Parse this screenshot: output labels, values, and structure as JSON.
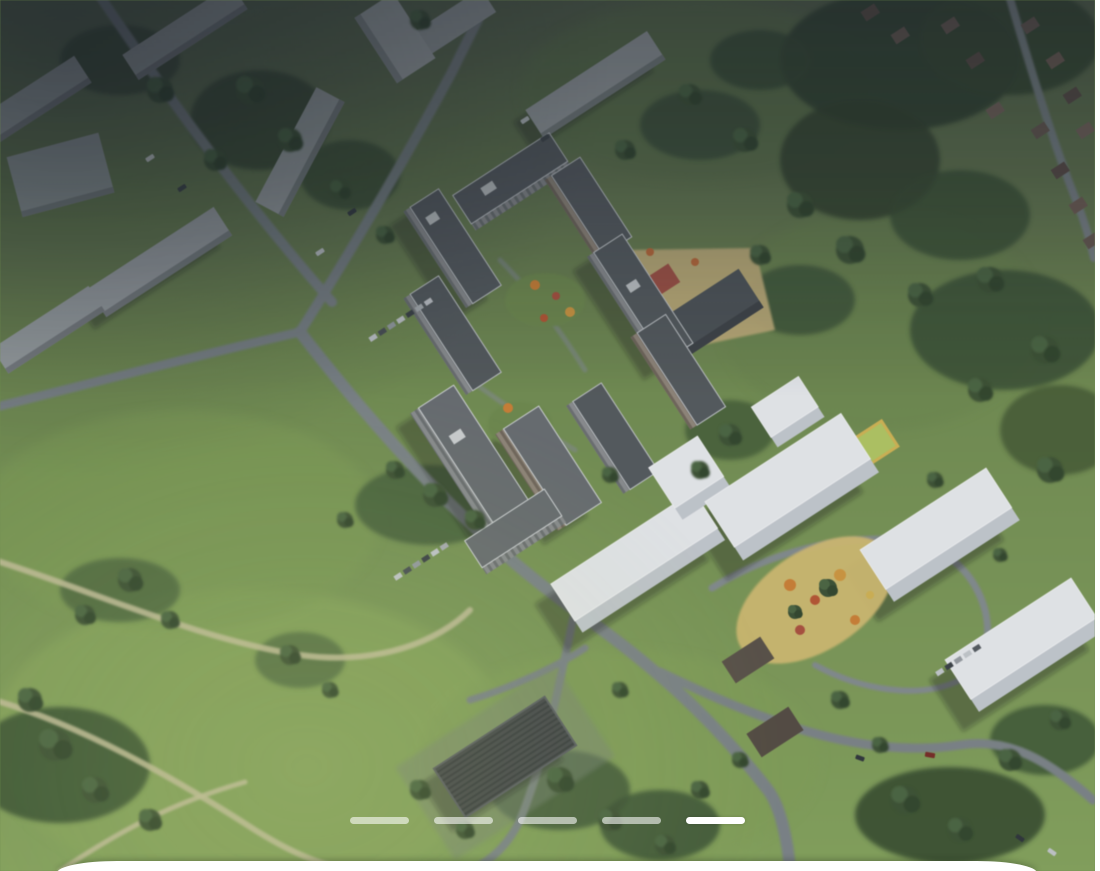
{
  "app": {
    "view": "real-estate-listing-photo-viewer"
  },
  "carousel": {
    "slide_count": 5,
    "active_slide": 5,
    "dash_inactive": "rgba(255,255,255,0.58)",
    "dash_active": "#ffffff"
  },
  "photo": {
    "alt": "Aerial 3D masterplan render of a residential complex: striped mid-rise towers with courtyards, white future-phase blocks with an orange playground, existing town blocks top-left, forest and cottage village top-right, green meadows with winding paths, a ribbed warehouse at bottom",
    "palette": {
      "meadow": "#7d9c52",
      "meadow_bright": "#8fae5d",
      "meadow_shaded": "#55654a",
      "forest": "#36492e",
      "road": "#7e868a",
      "dirt_path": "#c9c49b",
      "existing_building": "#a4a9ac",
      "tower_facade": "#8e9092",
      "tower_facade_warm": "#95897b",
      "tower_roof": "#565b5f",
      "white_block": "#eef0f3",
      "sand_yard": "#c7b278",
      "playground_orange": "#d6822f",
      "sport_red": "#a3403a",
      "shade_top": "#1b242b"
    }
  },
  "bottom_sheet": {
    "color": "#ffffff"
  }
}
